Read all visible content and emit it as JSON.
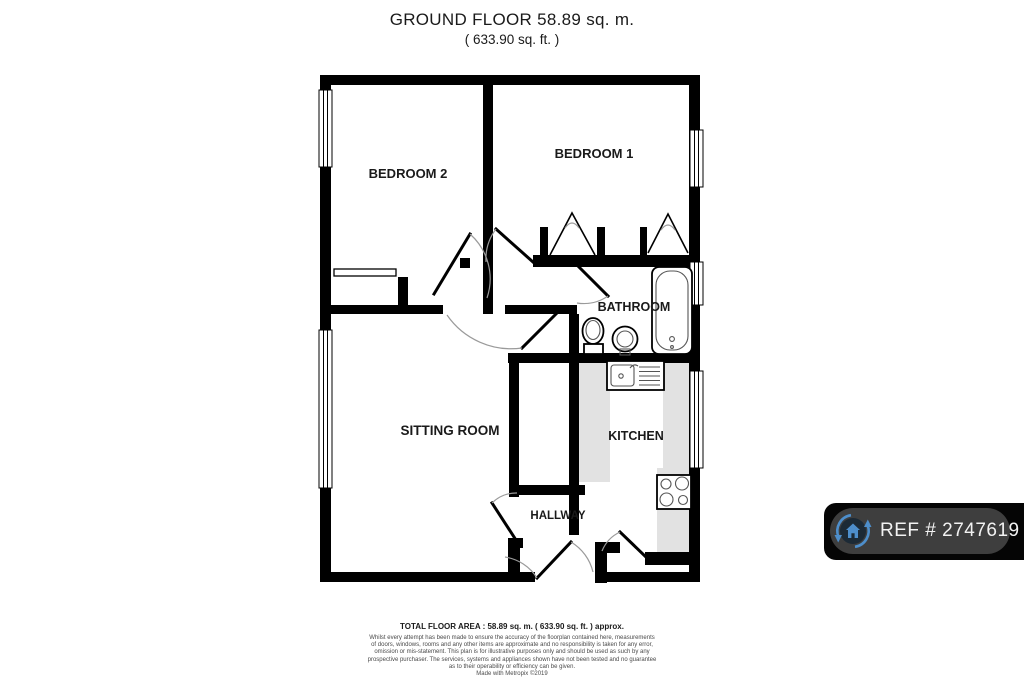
{
  "title": {
    "line1": "GROUND FLOOR 58.89 sq. m.",
    "line2": "( 633.90 sq. ft. )"
  },
  "room_labels": {
    "bedroom2": "BEDROOM 2",
    "bedroom1": "BEDROOM 1",
    "bathroom": "BATHROOM",
    "sitting_room": "SITTING ROOM",
    "kitchen": "KITCHEN",
    "hallway": "HALLWAY"
  },
  "footer": {
    "total_area": "TOTAL FLOOR AREA : 58.89 sq. m. ( 633.90 sq. ft. ) approx.",
    "disclaimer_lines": [
      "Whilst every attempt has been made to ensure the accuracy of the floorplan contained here, measurements",
      "of doors, windows, rooms and any other items are approximate and no responsibility is taken for any error,",
      "omission or mis-statement. This plan is for illustrative purposes only and should be used as such by any",
      "prospective purchaser. The services, systems and appliances shown have not been tested and no guarantee",
      "as to their operability or efficiency can be given.",
      "Made with Metropix ©2019"
    ]
  },
  "badge": {
    "ref": "REF # 2747619",
    "icon": "house-sync-icon"
  },
  "colors": {
    "wall": "#000000",
    "counter": "#e2e2e2",
    "badge_band": "#050505",
    "badge_pill": "#3e3e3e",
    "badge_text": "#f2f2f2",
    "badge_blue": "#4d8ecb",
    "badge_icon_bg": "#1c2a36",
    "disclaimer_text": "#4a4a4a"
  }
}
